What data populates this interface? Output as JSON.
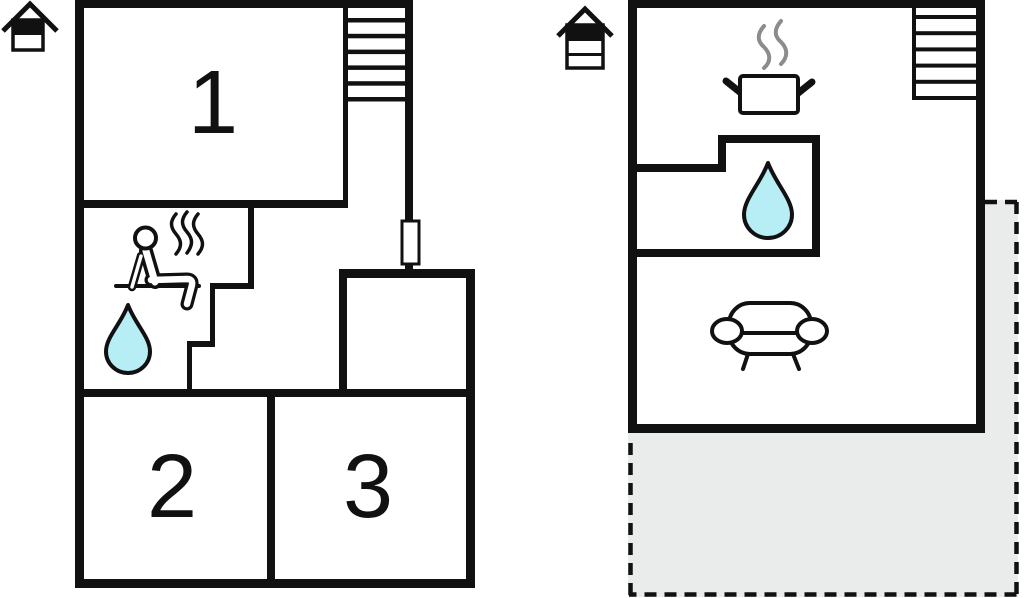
{
  "title": "Holiday house floor plans",
  "colors": {
    "wall": "#111111",
    "water": "#b7edf4",
    "terrace_fill": "#e9eceb",
    "steam_gray": "#8c8c8c",
    "background": "#ffffff"
  },
  "plans": {
    "left": {
      "name": "plan-level-a",
      "room_labels": {
        "room1": "1",
        "room2": "2",
        "room3": "3"
      },
      "icons": [
        "house-2-storey-top-highlighted",
        "staircase",
        "sauna-person",
        "steam",
        "water-drop",
        "door"
      ]
    },
    "right": {
      "name": "plan-level-b",
      "icons": [
        "house-3-storey-top-highlighted",
        "staircase",
        "cooking-pot",
        "steam",
        "water-drop",
        "sofa",
        "terrace-dashed"
      ]
    }
  }
}
